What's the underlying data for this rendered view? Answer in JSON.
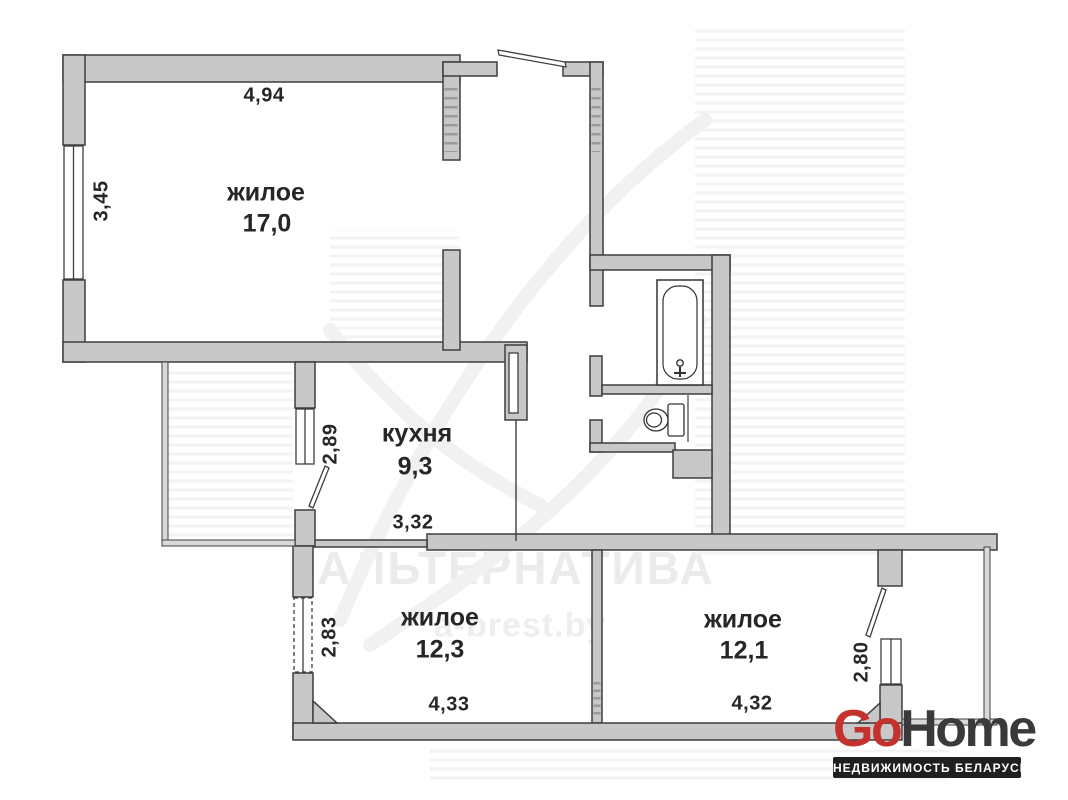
{
  "floorplan": {
    "rooms": {
      "living1": {
        "label": "жилое",
        "area": "17,0",
        "width": "4,94",
        "height": "3,45"
      },
      "kitchen": {
        "label": "кухня",
        "area": "9,3",
        "width": "3,32",
        "height": "2,89"
      },
      "living2": {
        "label": "жилое",
        "area": "12,3",
        "width": "4,33",
        "height": "2,83"
      },
      "living3": {
        "label": "жилое",
        "area": "12,1",
        "width": "4,32",
        "balcony_depth": "2,80"
      }
    },
    "fixtures": [
      {
        "icon": "bathtub-icon",
        "room": "bathroom"
      },
      {
        "icon": "toilet-icon",
        "room": "wc"
      }
    ],
    "colors": {
      "wall_fill": "#c8c8c8",
      "wall_outline": "#3e3e3e",
      "thin_wall_fill": "#d9d9d9",
      "label_text": "#262626"
    }
  },
  "watermark": {
    "title": "АЛЬТЕРНАТИВА",
    "site": "a-brest.by"
  },
  "logo": {
    "go": "Go",
    "home": "Home",
    "tagline": "НЕДВИЖИМОСТЬ БЕЛАРУСИ",
    "go_color": "#c5322e",
    "home_color": "#3a3a3a",
    "tagline_bg": "#1f1f1f"
  }
}
